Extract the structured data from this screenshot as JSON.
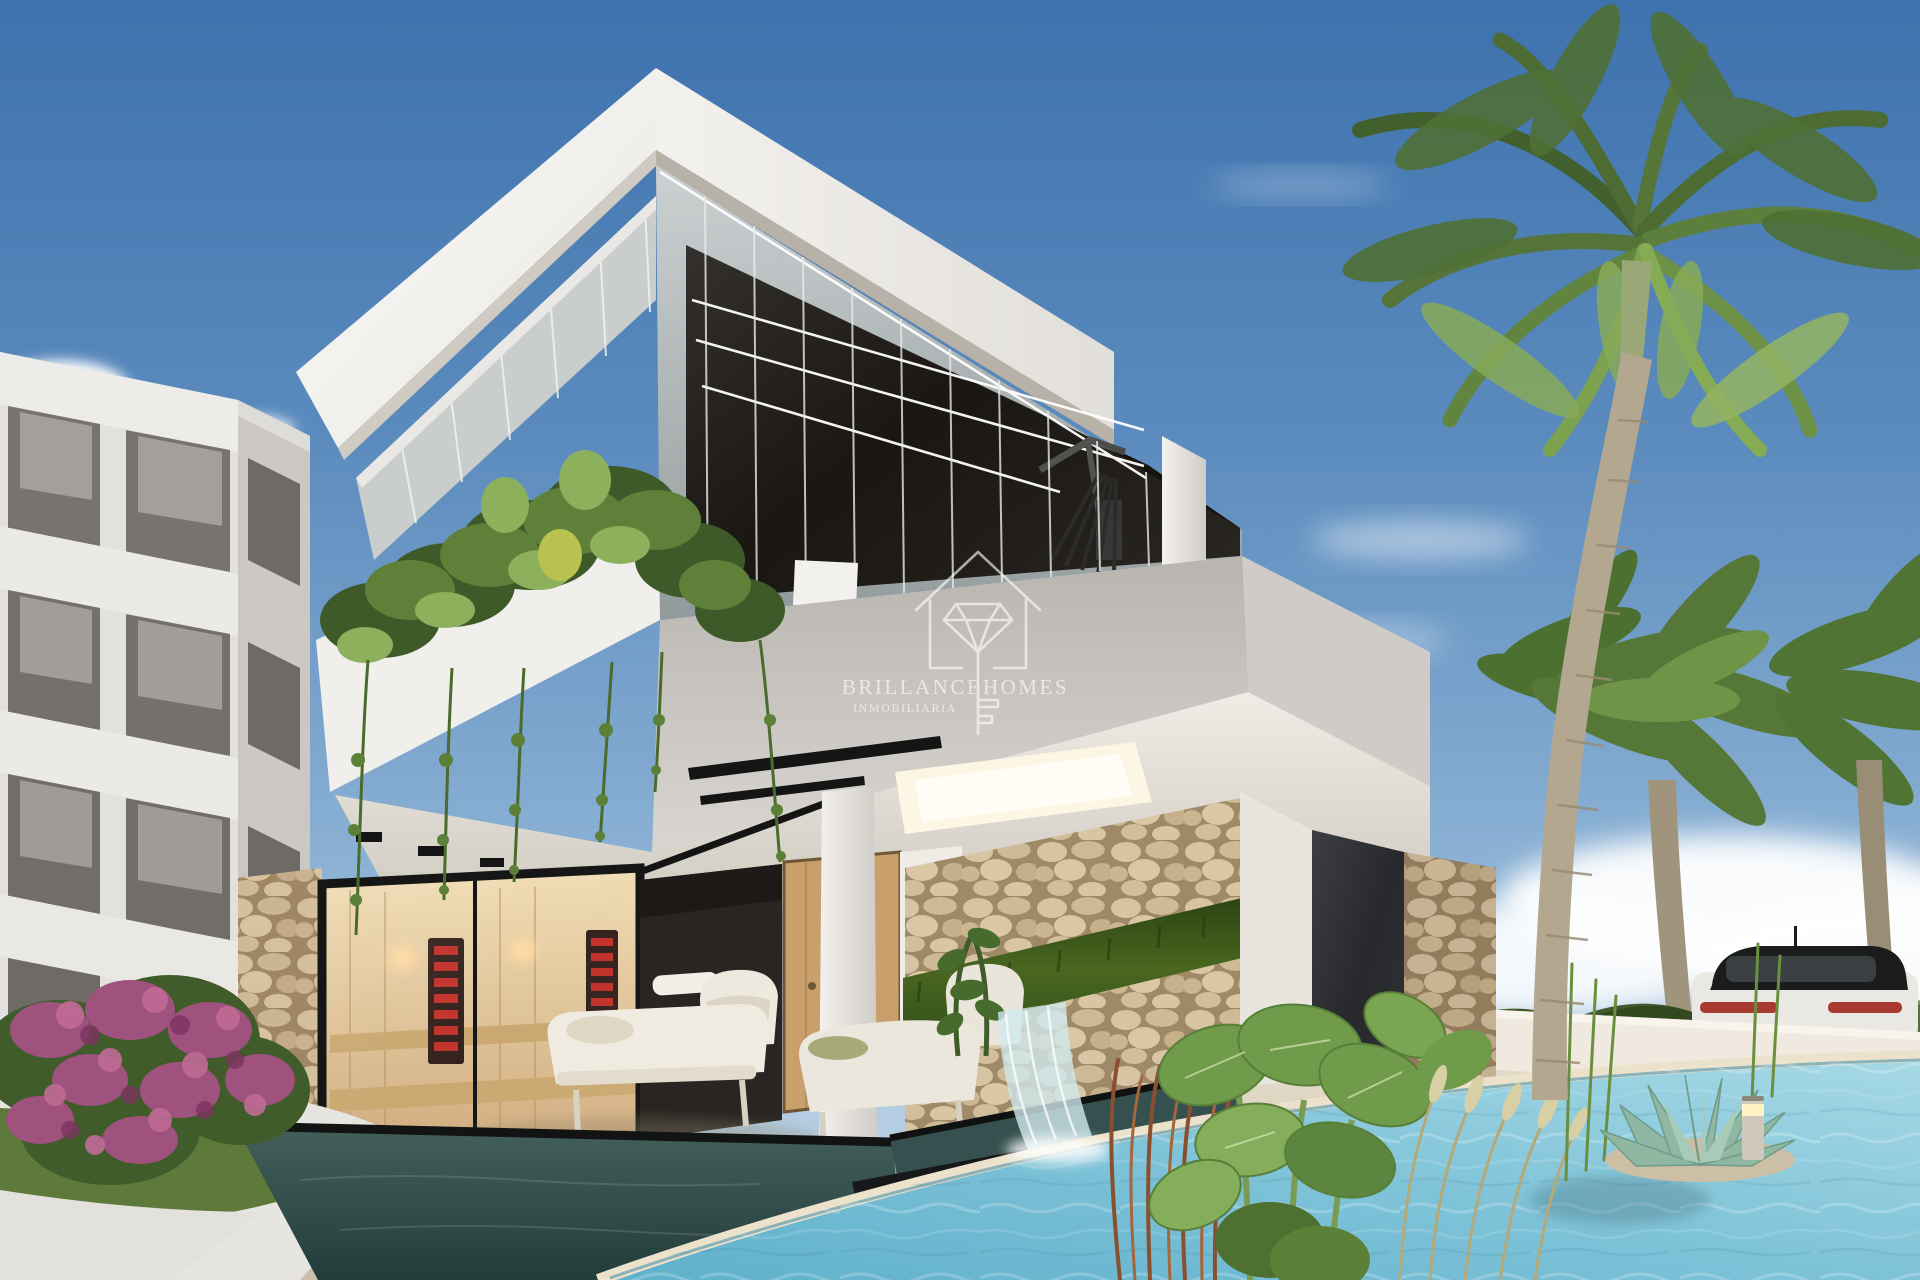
{
  "image_type": "architectural-render-photo",
  "watermark": {
    "brand_left": "BRILLANCE",
    "brand_right": "HOMES",
    "subtitle": "INMOBILIARIA",
    "logo_icon": "house-diamond-key-icon"
  },
  "scene": {
    "description": "Modern two-storey white villa with glass-walled upper gym floor, hanging balcony plants, stone-clad walls with moss strip and waterfall spa, indoor sauna, covered terrace with white lounge furniture, turquoise pool with tropical planting, apartment building at left, palm trees, white perimeter wall with SUV behind, blue sky with clouds",
    "objects": [
      "sky",
      "clouds",
      "royal-palm",
      "fan-palms",
      "background-trees",
      "apartment-building",
      "villa-roof",
      "glass-facade",
      "gym-interior",
      "balcony-plants",
      "stone-pillars",
      "sauna",
      "dark-wall",
      "wood-door",
      "terrace-ceiling",
      "skylight",
      "lounge-furniture",
      "moss-wall",
      "waterfall",
      "spa-pool",
      "lap-pool",
      "main-pool",
      "pool-deck",
      "perimeter-wall",
      "car",
      "bougainvillea",
      "lawn",
      "walkway",
      "alocasia-plants",
      "red-grasses",
      "ornamental-grasses",
      "succulent",
      "reeds",
      "bollard-light"
    ]
  },
  "palette": {
    "sky_top": "#3e72ae",
    "sky_horizon": "#cfdfec",
    "cloud_white": "#ffffff",
    "villa_white": "#f7f6f3",
    "villa_shade": "#d6d3ce",
    "band_gray": "#c4c1bc",
    "soffit_warm": "#beb8ac",
    "glass_gray": "#aab3b6",
    "interior_dark": "#16130f",
    "led_white": "#ffffff",
    "stone_tan": "#cdb795",
    "stone_gap": "#8d7759",
    "moss_green": "#3c5a1e",
    "sauna_wood": "#e2c89c",
    "heater_red": "#c03028",
    "pool_turquoise": "#7fc3d8",
    "pool_deep": "#5aa9c4",
    "spa_dark": "#35504e",
    "deck_beige": "#dbd2bf",
    "path_light": "#e7e5e0",
    "grass_green": "#5d7a3a",
    "foliage_dark": "#3d5a28",
    "foliage_mid": "#5f8038",
    "foliage_light": "#8db05c",
    "bougainvillea_pink": "#a0527f",
    "palm_trunk": "#b3a78f",
    "car_white": "#eae8e3",
    "car_roof_black": "#1c1c1c",
    "taillight_red": "#a83a30",
    "wall_white": "#efe9df",
    "watermark_white": "#ffffff"
  }
}
